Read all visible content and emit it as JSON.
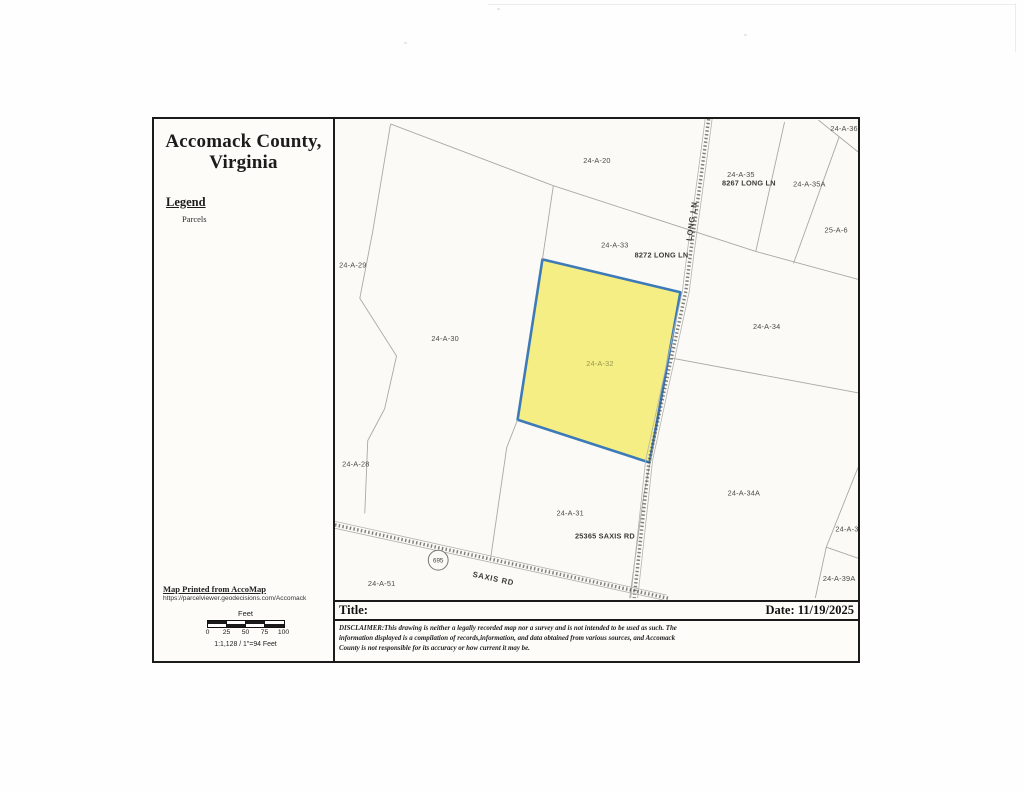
{
  "panel": {
    "county_title": "Accomack County,\nVirginia",
    "legend_heading": "Legend",
    "legend_items": [
      {
        "label": "Parcels"
      }
    ],
    "print_source": "Map Printed from AccoMap",
    "print_url": "https://parcelviewer.geodecisions.com/Accomack",
    "scale": {
      "unit_label": "Feet",
      "ticks": [
        "0",
        "25",
        "50",
        "75",
        "100"
      ],
      "ratio_text": "1:1,128 / 1\"=94 Feet"
    }
  },
  "footer": {
    "title_label": "Title:",
    "date_label": "Date: 11/19/2025",
    "disclaimer": "DISCLAIMER:This drawing is neither a legally recorded map nor a survey and is not intended to be used as such.  The\ninformation displayed is a compilation of records,information, and data obtained from various sources, and Accomack\nCounty is not responsible for its accuracy or how current it may be."
  },
  "map": {
    "selected_parcel": {
      "id": "24-A-32",
      "fill_color": "#f4ee84",
      "outline_color": "#3d7ab8"
    },
    "line_color": "#a9a9a4",
    "route_shield": {
      "number": "695"
    },
    "roads": [
      "LONG LN",
      "SAXIS RD"
    ],
    "labels": [
      {
        "text": "24-A-20",
        "x": 264,
        "y": 44,
        "cls": ""
      },
      {
        "text": "24-A-33",
        "x": 282,
        "y": 129,
        "cls": ""
      },
      {
        "text": "8272 LONG LN",
        "x": 329,
        "y": 139,
        "cls": "address"
      },
      {
        "text": "LONG LN",
        "x": 362,
        "y": 103,
        "cls": "road",
        "rot": -82
      },
      {
        "text": "24-A-35",
        "x": 409,
        "y": 58,
        "cls": ""
      },
      {
        "text": "8267 LONG LN",
        "x": 417,
        "y": 67,
        "cls": "address"
      },
      {
        "text": "24-A-35A",
        "x": 478,
        "y": 68,
        "cls": ""
      },
      {
        "text": "25-A-6",
        "x": 505,
        "y": 114,
        "cls": ""
      },
      {
        "text": "24-A-36",
        "x": 513,
        "y": 12,
        "cls": ""
      },
      {
        "text": "24-A-29",
        "x": 18,
        "y": 149,
        "cls": ""
      },
      {
        "text": "24-A-30",
        "x": 111,
        "y": 223,
        "cls": ""
      },
      {
        "text": "24-A-32",
        "x": 267,
        "y": 248,
        "cls": "selected"
      },
      {
        "text": "24-A-34",
        "x": 435,
        "y": 211,
        "cls": ""
      },
      {
        "text": "24-A-28",
        "x": 21,
        "y": 349,
        "cls": ""
      },
      {
        "text": "24-A-31",
        "x": 237,
        "y": 398,
        "cls": ""
      },
      {
        "text": "25365 SAXIS RD",
        "x": 272,
        "y": 421,
        "cls": "address"
      },
      {
        "text": "24-A-34A",
        "x": 412,
        "y": 378,
        "cls": ""
      },
      {
        "text": "24-A-39",
        "x": 518,
        "y": 414,
        "cls": ""
      },
      {
        "text": "24-A-39A",
        "x": 508,
        "y": 464,
        "cls": ""
      },
      {
        "text": "24-A-51",
        "x": 47,
        "y": 469,
        "cls": ""
      },
      {
        "text": "SAXIS RD",
        "x": 159,
        "y": 464,
        "cls": "road",
        "rot": 12
      }
    ]
  }
}
